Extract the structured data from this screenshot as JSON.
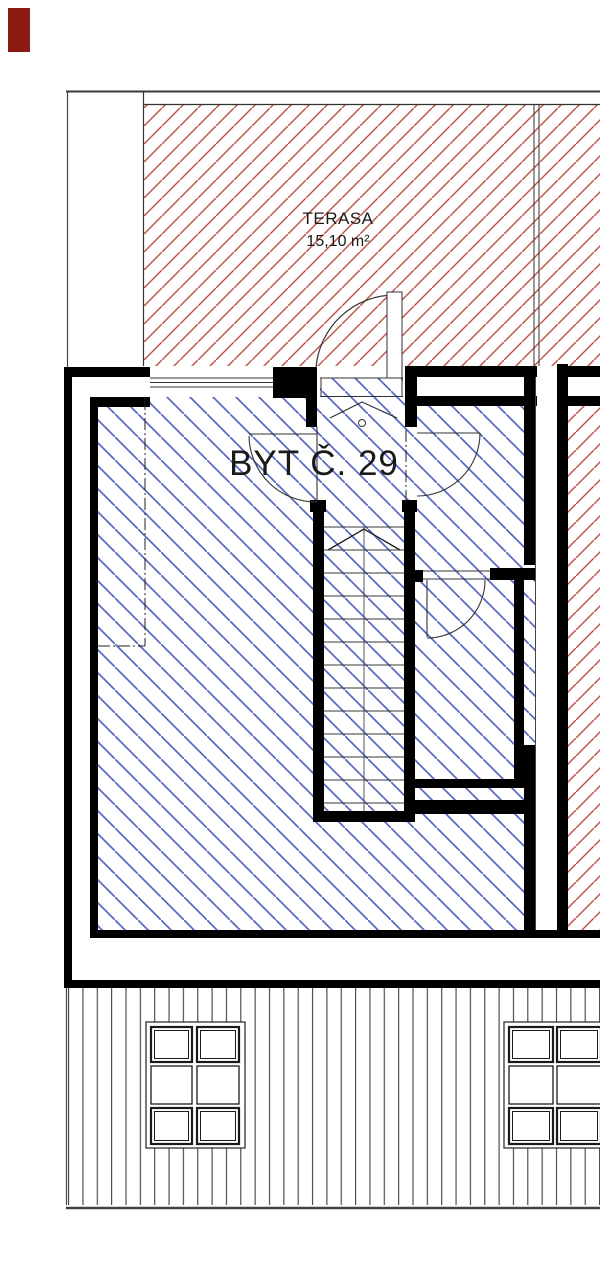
{
  "labels": {
    "terrace": {
      "name": "TERASA",
      "area": "15,10 m²"
    },
    "unit": {
      "name": "BYT Č. 29"
    }
  },
  "colors": {
    "terrace_hatch": "#c4544b",
    "unit_hatch": "#5668c4",
    "wall": "#000000",
    "thin_line": "#333333",
    "marker_box": "#8a1a12",
    "deck_stripe": "#3f3f3f"
  }
}
